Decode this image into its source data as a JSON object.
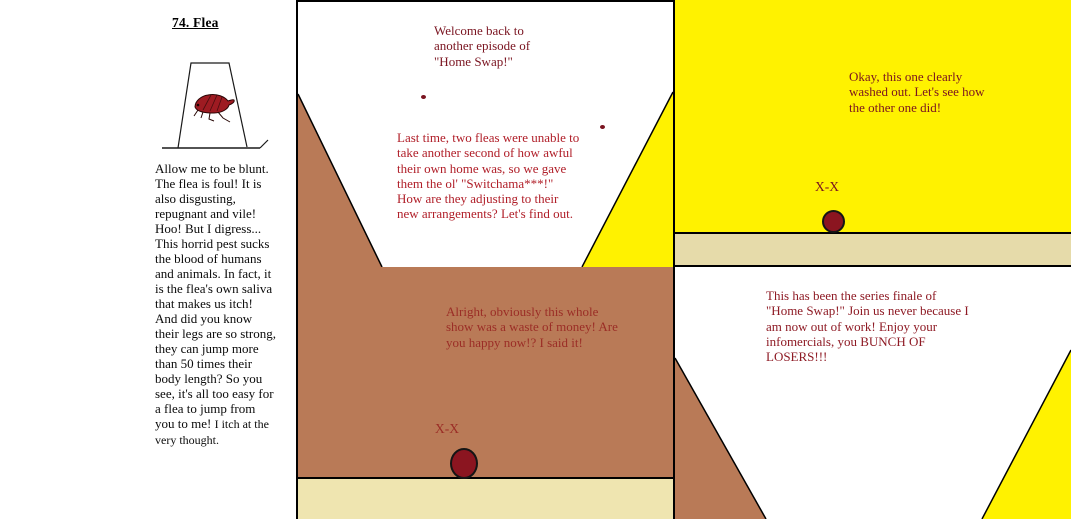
{
  "comic": {
    "number_title": "74. Flea",
    "illustration": "dead-flea-under-lampshade-drawing"
  },
  "left_column": {
    "paragraph_main": "Allow me to be blunt.\nThe flea is foul! It is\nalso disgusting,\nrepugnant and vile!\nHoo! But I digress...\nThis horrid pest sucks\nthe blood of humans\nand animals. In fact, it\nis the flea's own saliva\nthat makes us itch!\nAnd did you know\ntheir legs are so strong,\nthey can jump more\nthan 50 times their\nbody length? So you\nsee, it's all too easy for\na flea to jump from\nyou to me! ",
    "paragraph_end": "I itch at the\nvery thought."
  },
  "panels": {
    "top_middle": {
      "narration_1": "Welcome back to\nanother episode of\n\"Home Swap!\"",
      "narration_2": "Last time, two fleas were unable to\ntake another second of how awful\ntheir own home was, so we gave\nthem the ol' \"Switchama***!\"\nHow are they adjusting to their\nnew arrangements? Let's find out."
    },
    "top_right": {
      "speech": "Okay, this one clearly\nwashed out. Let's see how\nthe other one did!",
      "flea_eyes": "X-X"
    },
    "bottom_middle": {
      "speech": "Alright, obviously this whole\nshow was a waste of money! Are\nyou happy now!? I said it!",
      "flea_eyes": "X-X"
    },
    "bottom_right": {
      "speech": "This has been the series finale of\n\"Home Swap!\" Join us never because I\nam now out of work! Enjoy your\ninfomercials, you BUNCH OF\nLOSERS!!!"
    }
  },
  "colors": {
    "panel_brown": "#B97A57",
    "panel_yellow": "#FFF200",
    "ground_tan": "#E6DBAA",
    "ground_cream": "#EFE5B0",
    "text_dark_red": "#7A1420",
    "text_bright_red": "#B01E28",
    "text_muted_red": "#9B2D26",
    "text_finale_red": "#8E1A24",
    "flea_body_red": "#8B1520"
  }
}
